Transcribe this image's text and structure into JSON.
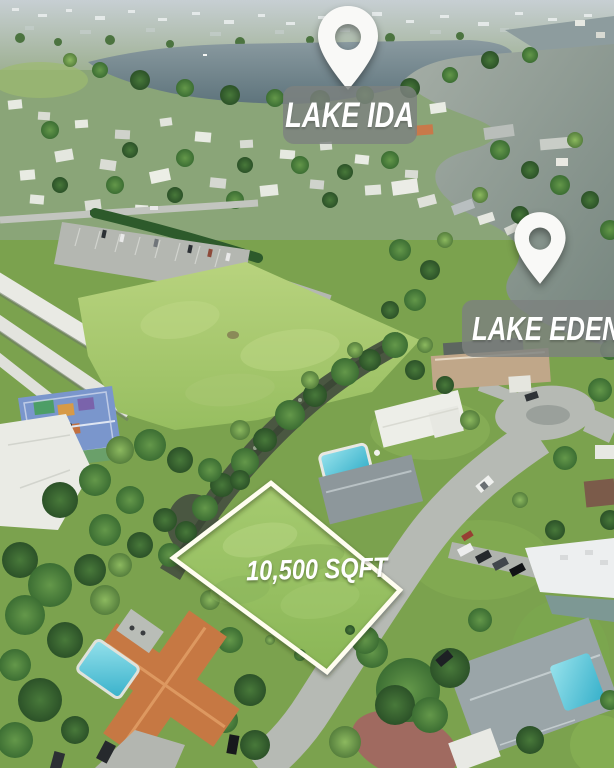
{
  "annotations": {
    "lake_ida": {
      "label": "LAKE IDA",
      "icon": "map-pin-icon"
    },
    "lake_eden": {
      "label": "LAKE EDEN",
      "icon": "map-pin-icon"
    },
    "lot": {
      "label": "10,500 SQFT"
    }
  },
  "colors": {
    "pin_fill": "#f9f9f7",
    "label_bg": "rgba(125,129,127,0.82)",
    "label_text": "#ffffff",
    "lot_outline": "#fffdf0"
  }
}
